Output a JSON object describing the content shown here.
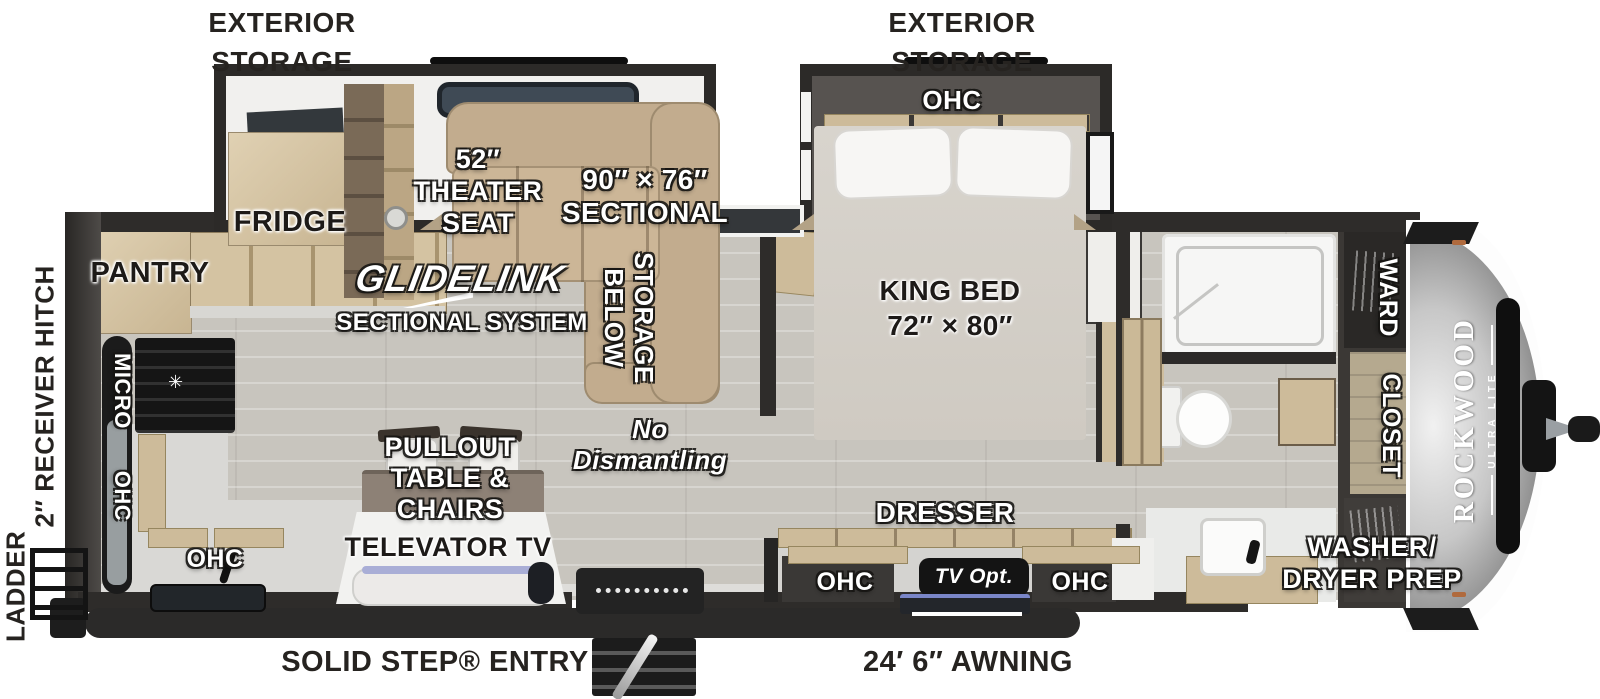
{
  "title": "Rockwood Ultra Lite travel trailer floorplan",
  "colors": {
    "floor": "#c8c5be",
    "wall": "#2e2c2a",
    "sofa_tan": "#c2ac8e",
    "wood": "#cdbb9a",
    "cap_silver": "#c9c9c9",
    "badge_black": "#141414"
  },
  "exterior": {
    "storage_left": "EXTERIOR\nSTORAGE",
    "storage_right": "EXTERIOR\nSTORAGE",
    "ladder": "LADDER",
    "receiver_hitch": "2″ RECEIVER HITCH",
    "solid_step_entry": "SOLID STEP® ENTRY",
    "awning": "24′ 6″ AWNING"
  },
  "living_slide": {
    "fridge": "FRIDGE",
    "theater_seat": "52″\nTHEATER\nSEAT",
    "sectional": "90″ × 76″\nSECTIONAL"
  },
  "living": {
    "glidelink": "GLIDELINK",
    "glidelink_sub": "SECTIONAL SYSTEM",
    "storage_below": "STORAGE\nBELOW",
    "no_dismantling": "No\nDismantling",
    "pullout_table": "PULLOUT\nTABLE &\nCHAIRS",
    "televator_tv": "TELEVATOR TV"
  },
  "kitchen": {
    "pantry": "PANTRY",
    "micro": "MICRO",
    "ohc_wall": "OHC",
    "ohc_counter": "OHC"
  },
  "bedroom": {
    "ohc_slide": "OHC",
    "king_bed": "KING BED\n72″ × 80″",
    "dresser": "DRESSER",
    "ohc_left": "OHC",
    "ohc_right": "OHC",
    "tv_opt": "TV Opt."
  },
  "front": {
    "ward": "WARD",
    "closet": "CLOSET",
    "washer_dryer": "WASHER/\nDRYER PREP",
    "brand": "ROCKWOOD",
    "brand_sub": "ULTRA LITE"
  }
}
